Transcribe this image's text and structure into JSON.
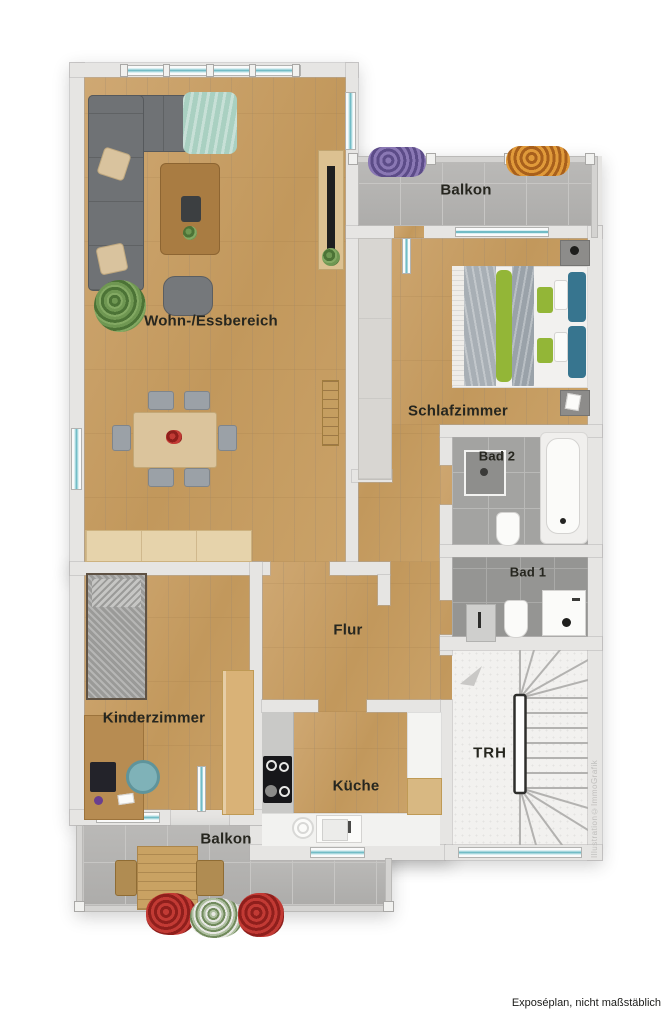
{
  "plan": {
    "caption": "Exposéplan, nicht maßstäblich",
    "watermark": "Illustration©ImmoGrafik",
    "rooms": {
      "living": {
        "label": "Wohn-/Essbereich"
      },
      "balcony_top": {
        "label": "Balkon"
      },
      "bedroom": {
        "label": "Schlafzimmer"
      },
      "bath2": {
        "label": "Bad 2"
      },
      "bath1": {
        "label": "Bad 1"
      },
      "hall": {
        "label": "Flur"
      },
      "kids": {
        "label": "Kinderzimmer"
      },
      "kitchen": {
        "label": "Küche"
      },
      "stairwell": {
        "label": "TRH"
      },
      "balcony_bottom": {
        "label": "Balkon"
      }
    },
    "colors": {
      "wood_floor": "#c59c63",
      "balcony_tile": "#b4b3b1",
      "bath_tile": "#a3a3a1",
      "wall": "#e6e5e3",
      "window_glass": "#9fd8df",
      "sofa_gray": "#6f7275",
      "pillow_teal": "#37758f",
      "pillow_green": "#93b637",
      "throw_mint": "#a9d0c1"
    }
  }
}
